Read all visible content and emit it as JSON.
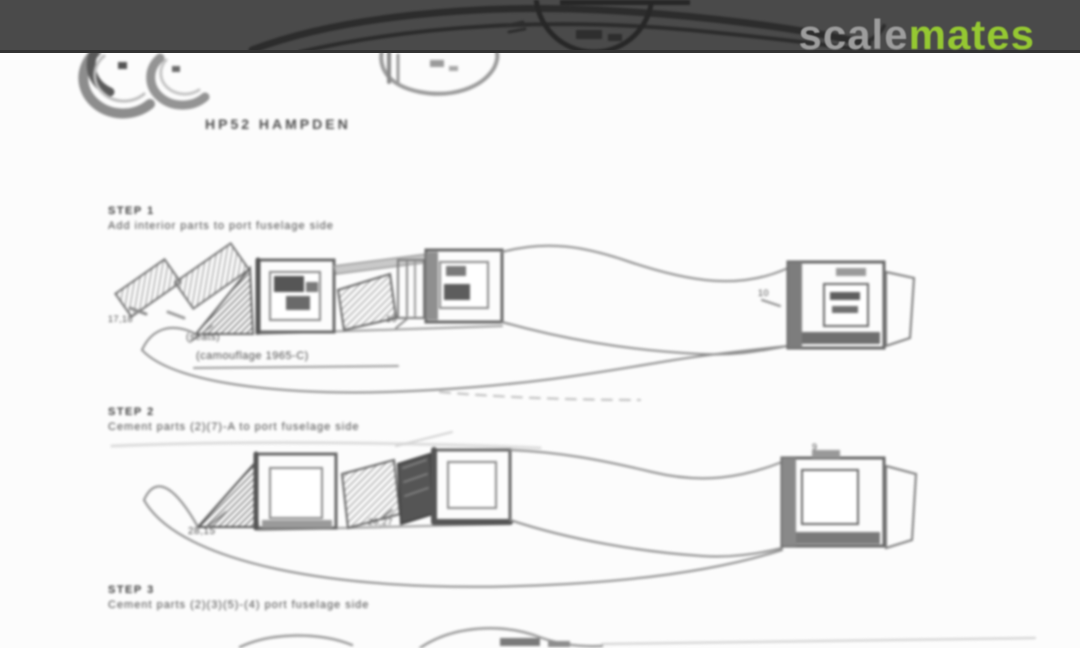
{
  "header": {
    "logo": {
      "scale": "scale",
      "mates": "mates"
    },
    "colors": {
      "band": "#4a4a4a",
      "logo_scale": "#9d9d9d",
      "logo_mates": "#95c832"
    }
  },
  "document": {
    "paper_color": "#fcfcfc",
    "ink_color": "#6f6f6f",
    "caption": "HP52 HAMPDEN",
    "steps": [
      {
        "title": "STEP 1",
        "instruction": "Add interior parts to port fuselage side",
        "labels": {
          "parts": "17,18",
          "mid": "16",
          "note1": "(seats)",
          "note2": "(camouflage 1965-C)",
          "tail": "10"
        }
      },
      {
        "title": "STEP 2",
        "instruction": "Cement parts (2)(7)-A to port fuselage side",
        "labels": {
          "nose": "28,15",
          "mid": "26,27",
          "tail": "9"
        }
      },
      {
        "title": "STEP 3",
        "instruction": "Cement parts (2)(3)(5)-(4) port fuselage side",
        "labels": {}
      }
    ]
  }
}
